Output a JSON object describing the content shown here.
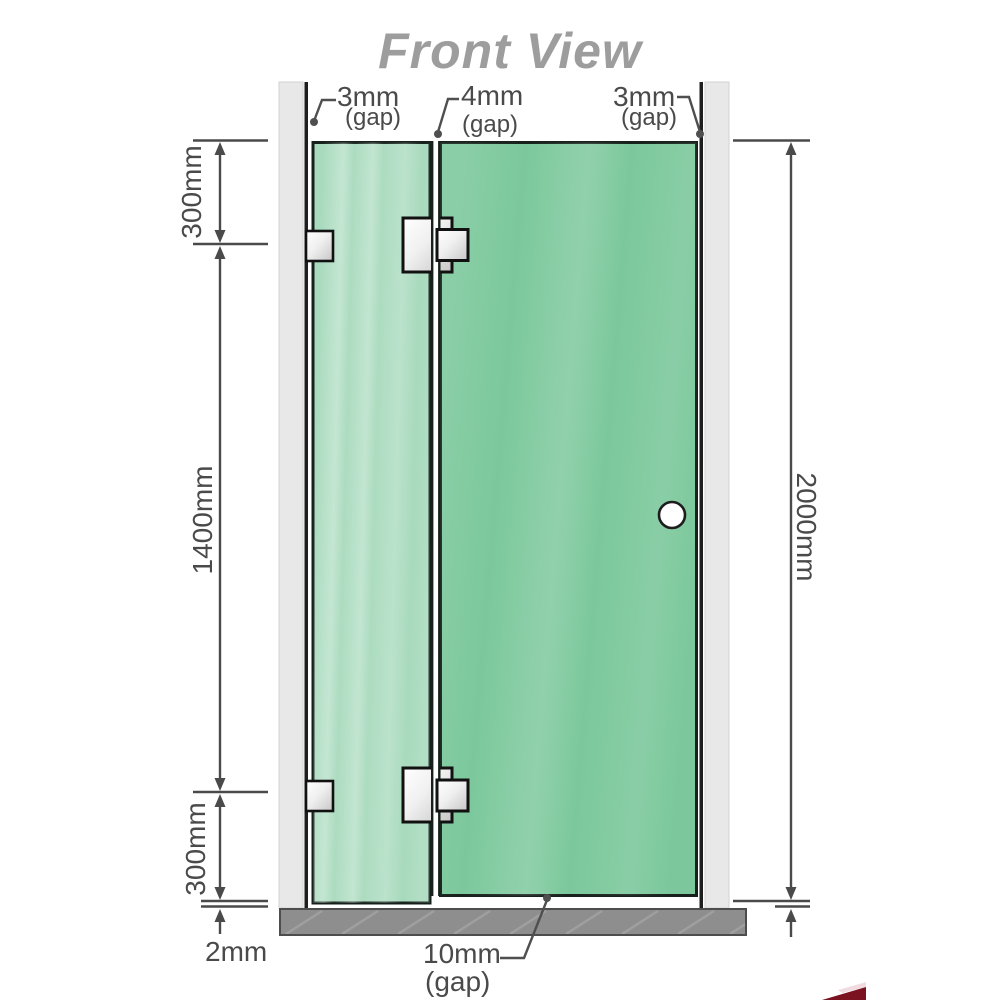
{
  "title": "Front View",
  "annotations": {
    "top_left_gap": {
      "value": "3mm",
      "suffix": "(gap)"
    },
    "top_mid_gap": {
      "value": "4mm",
      "suffix": "(gap)"
    },
    "top_right_gap": {
      "value": "3mm",
      "suffix": "(gap)"
    },
    "bottom_gap": {
      "value": "10mm",
      "suffix": "(gap)"
    }
  },
  "dimensions": {
    "left_top": "300mm",
    "left_middle": "1400mm",
    "left_bottom": "300mm",
    "floor_gap": "2mm",
    "right_height": "2000mm"
  },
  "colors": {
    "glass_fixed": "#a8dabd",
    "glass_door": "#7cc89c",
    "glass_outline": "#15211a",
    "wall": "#e8e8e8",
    "wall_inner_line": "#1e1e1e",
    "floor": "#8e8e8e",
    "floor_outline": "#4d4d4d",
    "dimension": "#4a4a4a",
    "title_gray": "#9d9d9d",
    "metal_hinge": "#d9d9d9",
    "logo_red": "#7a1220"
  }
}
